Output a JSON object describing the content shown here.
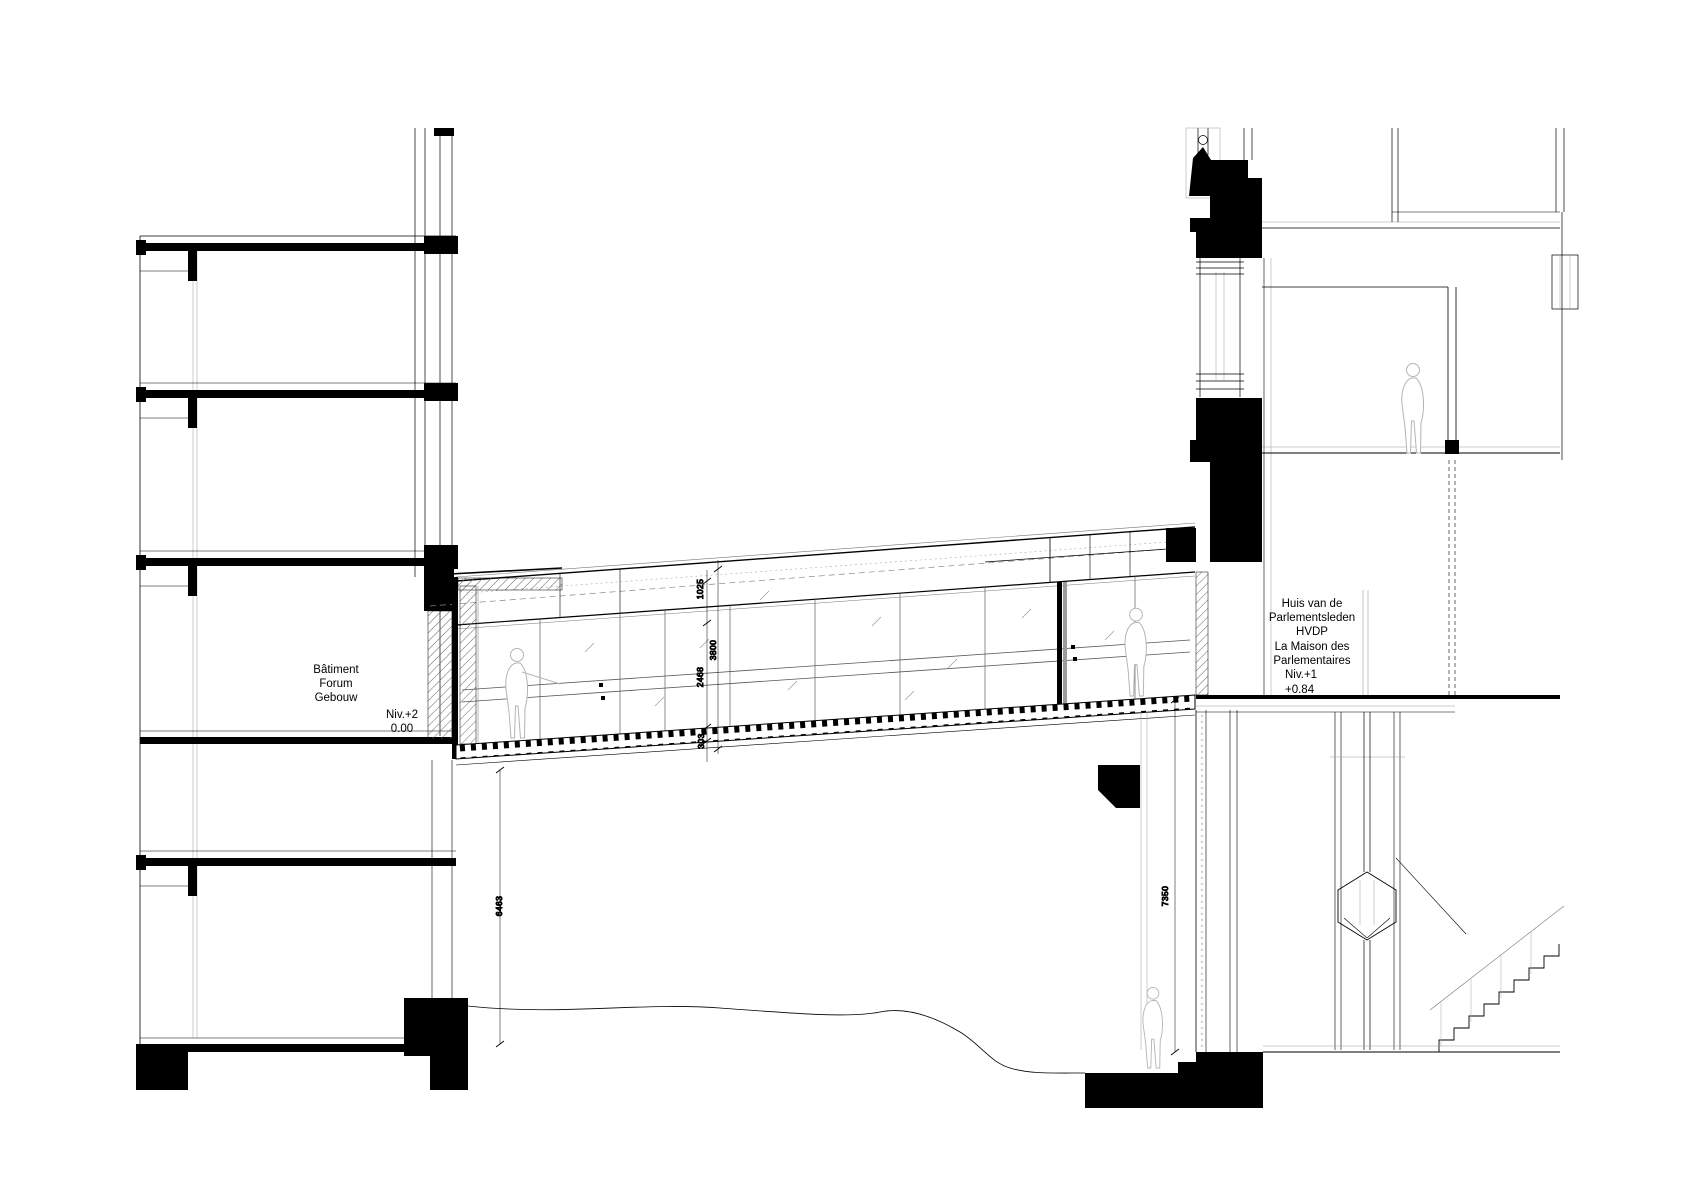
{
  "drawing": {
    "type": "architectural-section",
    "left_building": {
      "line1": "Bâtiment",
      "line2": "Forum",
      "line3": "Gebouw",
      "level": "Niv.+2",
      "elevation": "0.00"
    },
    "right_building": {
      "line1": "Huis van de",
      "line2": "Parlementsleden",
      "line3": "HVDP",
      "line4": "La Maison des",
      "line5": "Parlementaires",
      "level": "Niv.+1",
      "elevation": "+0.84"
    },
    "dimensions": {
      "bridge_fascia_height": "1025",
      "bridge_overall_height": "3800",
      "bridge_glass_height": "2468",
      "bridge_floor_depth": "303",
      "left_ground_clearance": "6463",
      "right_ground_clearance": "7350"
    },
    "colors": {
      "ink": "#000000",
      "figure_outline": "#b4b4b4",
      "background": "#ffffff"
    }
  }
}
